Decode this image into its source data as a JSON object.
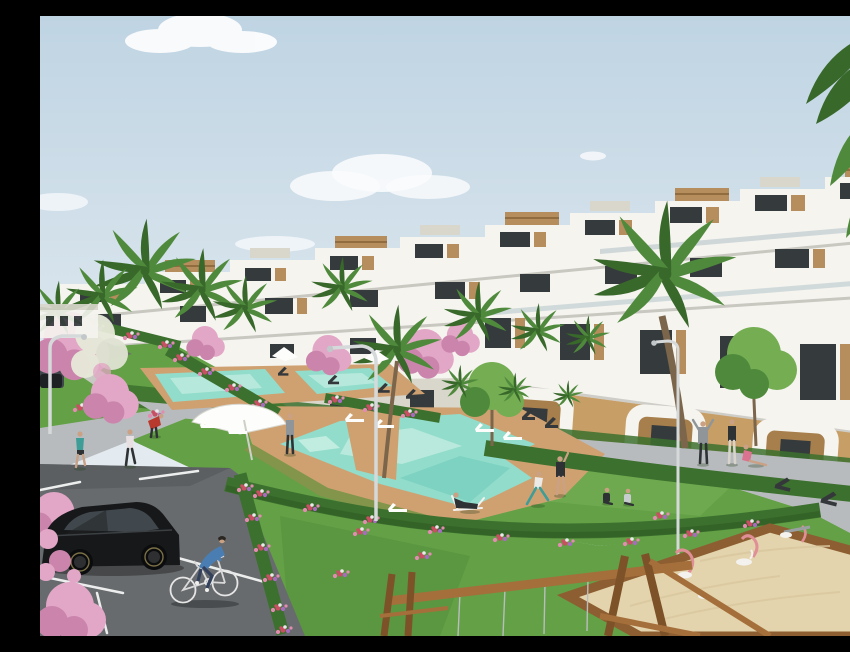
{
  "canvas": {
    "width": 850,
    "height": 620
  },
  "scene": {
    "type": "architectural rendering",
    "description": "Sunny 3D architectural rendering of a modern white terraced apartment complex with wood-slat rooftop accents, palm trees and pink blossom trees, turquoise swimming pools with wooden decks, lawns where people exercise and relax, a parking lot with a black hatchback and a man cycling, and a children's play area with a sandbox and wooden swing frame.",
    "sky": {
      "condition": "clear pale-blue sky with scattered soft clouds"
    },
    "building": {
      "style": "stepped terraced apartment block",
      "facade": "white with dark glazing and wood-slat penthouse boxes",
      "floors_visible": 4,
      "features": [
        "stepped rooflines rising to the right",
        "long white balcony bands",
        "arched ground-floor porticos with ochre walls"
      ]
    },
    "amenities": [
      "lap pools",
      "main free-form pool",
      "wooden pool deck",
      "white sun loungers",
      "white parasols",
      "dark lounge benches",
      "curved street lamps",
      "sandbox with pink spring riders",
      "wooden swing frame"
    ],
    "people": [
      {
        "activity": "jogging",
        "count": 2
      },
      {
        "activity": "cycling",
        "count": 1
      },
      {
        "activity": "stretching and exercising on the lawn",
        "count": 3
      },
      {
        "activity": "sitting on the grass",
        "count": 3
      },
      {
        "activity": "standing or walking",
        "count": 3
      },
      {
        "activity": "lounging on a deck chair",
        "count": 1
      }
    ],
    "vehicles": [
      {
        "type": "black hatchback",
        "state": "parked in lot"
      },
      {
        "type": "dark car",
        "state": "distant on upper road"
      }
    ],
    "vegetation": [
      "palm trees",
      "pink blossom trees",
      "white blossom bush",
      "green leafy trees",
      "hedges with mixed flowers",
      "lawns"
    ]
  },
  "colors": {
    "sky-top": "#bfd4e3",
    "sky-low": "#edf1f4",
    "cloud": "#f8fafb",
    "white": "#ffffff",
    "bldg-white": "#f5f4ef",
    "bldg-cream": "#eceae2",
    "bldg-shade": "#d9d6cc",
    "win-dark": "#353a3d",
    "win-mid": "#55616a",
    "wood": "#b68d5c",
    "wood-dark": "#916c3e",
    "ochre": "#c79e66",
    "ochre-dark": "#a77f4c",
    "grass": "#63a046",
    "grass-light": "#79b257",
    "grass-dark": "#4e8a38",
    "hedge": "#3c702e",
    "hedge-dark": "#2e5a23",
    "palm": "#4f8a3c",
    "palm-dark": "#38682a",
    "palm-light": "#74ad52",
    "trunk": "#7b654b",
    "pink": "#e2a7c6",
    "pink-dark": "#cb85ad",
    "fl-red": "#c94f62",
    "fl-purple": "#a76cc0",
    "fl-white": "#ece9ee",
    "fl-rose": "#e38bb0",
    "pool": "#92dccb",
    "pool-light": "#c6eee2",
    "pool-deep": "#6fcbba",
    "deck": "#cfa171",
    "deck-dark": "#b2854f",
    "path": "#b8bbbe",
    "path-light": "#cfd2d3",
    "asphalt": "#686b6e",
    "asphalt-dark": "#54575a",
    "line": "#eceeee",
    "car": "#16181a",
    "car-glass": "#41484d",
    "lamp": "#d5d9da",
    "sand": "#e4d4ad",
    "box-wood": "#8d5e31",
    "swing": "#a56f3b",
    "swing-dark": "#7e5228",
    "play-pink": "#e18f96",
    "skin": "#caa184",
    "denim": "#33415c",
    "blue-shirt": "#4a7eb3",
    "red-shirt": "#b8392e",
    "teal": "#3f9d98",
    "pink-top": "#d9738f",
    "grey-cloth": "#8f9598",
    "dark-cloth": "#2e3234"
  }
}
